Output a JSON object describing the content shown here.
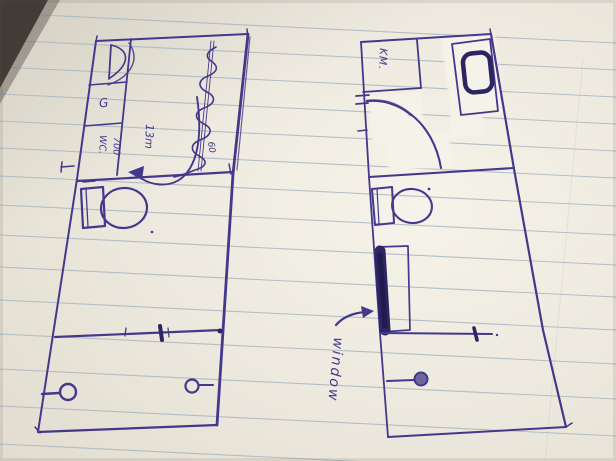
{
  "scene": {
    "paper_color": "#eae6db",
    "paper_highlight_color": "#f5f2e9",
    "ruled_line_color": "#a4b3be",
    "ink_color": "#43388c",
    "ink_dark_color": "#2d2464",
    "whiteout_color": "#f6f3e9",
    "corner_band_color": "#423c37"
  },
  "left_plan": {
    "labels": {
      "fixture_g": "G",
      "wc": "WC.",
      "dim_700": "700",
      "dim_13m": "13m",
      "dim_60": "60"
    }
  },
  "right_plan": {
    "labels": {
      "room_km": "KM.",
      "window": "window"
    }
  }
}
